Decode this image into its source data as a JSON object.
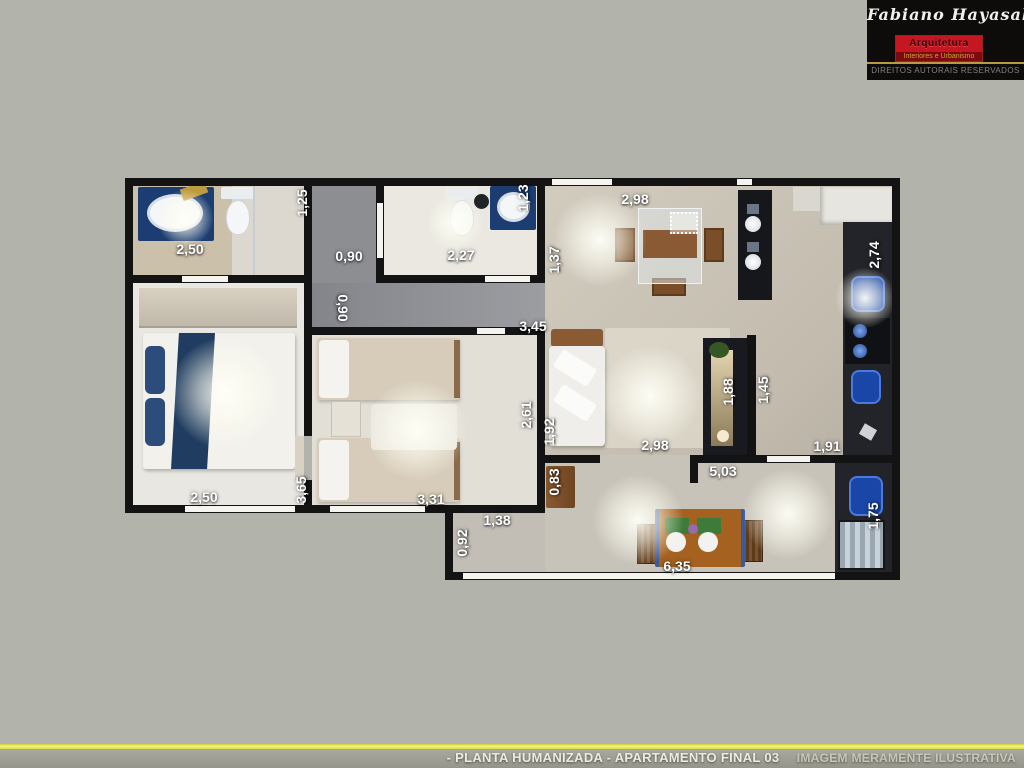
{
  "page": {
    "background": "#b2b3aa",
    "wall_color": "#131313"
  },
  "logo": {
    "name": "Fabiano Hayasaki",
    "field": "Arquitetura",
    "tagline": "Interiores e Urbanismo",
    "rights": "DIREITOS AUTORAIS RESERVADOS",
    "accent_color": "#c51622"
  },
  "footer": {
    "title": "- PLANTA HUMANIZADA - APARTAMENTO FINAL 03",
    "disclaimer": "IMAGEM MERAMENTE ILUSTRATIVA",
    "line_color": "#e8e84a"
  },
  "floorplan": {
    "unit": "m",
    "dimensions": [
      {
        "label": "2,50",
        "cx": 65,
        "cy": 71,
        "rot": 0
      },
      {
        "label": "1,25",
        "cx": 177,
        "cy": 25,
        "rot": -90
      },
      {
        "label": "0,90",
        "cx": 224,
        "cy": 78,
        "rot": 0
      },
      {
        "label": "2,27",
        "cx": 336,
        "cy": 77,
        "rot": 0
      },
      {
        "label": "1,23",
        "cx": 398,
        "cy": 20,
        "rot": -90
      },
      {
        "label": "1,37",
        "cx": 429,
        "cy": 82,
        "rot": -90
      },
      {
        "label": "2,98",
        "cx": 510,
        "cy": 21,
        "rot": 0
      },
      {
        "label": "2,74",
        "cx": 749,
        "cy": 77,
        "rot": -90
      },
      {
        "label": "0,90",
        "cx": 218,
        "cy": 130,
        "rot": 90
      },
      {
        "label": "3,45",
        "cx": 408,
        "cy": 148,
        "rot": 0
      },
      {
        "label": "2,61",
        "cx": 401,
        "cy": 237,
        "rot": -90
      },
      {
        "label": "1,92",
        "cx": 424,
        "cy": 254,
        "rot": -90
      },
      {
        "label": "1,88",
        "cx": 603,
        "cy": 214,
        "rot": -90
      },
      {
        "label": "1,45",
        "cx": 638,
        "cy": 212,
        "rot": -90
      },
      {
        "label": "2,98",
        "cx": 530,
        "cy": 267,
        "rot": 0
      },
      {
        "label": "1,91",
        "cx": 702,
        "cy": 268,
        "rot": 0
      },
      {
        "label": "5,03",
        "cx": 598,
        "cy": 293,
        "rot": 0
      },
      {
        "label": "0,83",
        "cx": 429,
        "cy": 304,
        "rot": -90
      },
      {
        "label": "3,65",
        "cx": 176,
        "cy": 312,
        "rot": -90
      },
      {
        "label": "2,50",
        "cx": 79,
        "cy": 319,
        "rot": 0
      },
      {
        "label": "3,31",
        "cx": 306,
        "cy": 321,
        "rot": 0
      },
      {
        "label": "1,38",
        "cx": 372,
        "cy": 342,
        "rot": 0
      },
      {
        "label": "0,92",
        "cx": 337,
        "cy": 365,
        "rot": -90
      },
      {
        "label": "6,35",
        "cx": 552,
        "cy": 388,
        "rot": 0
      },
      {
        "label": "1,75",
        "cx": 748,
        "cy": 338,
        "rot": -90
      }
    ]
  }
}
